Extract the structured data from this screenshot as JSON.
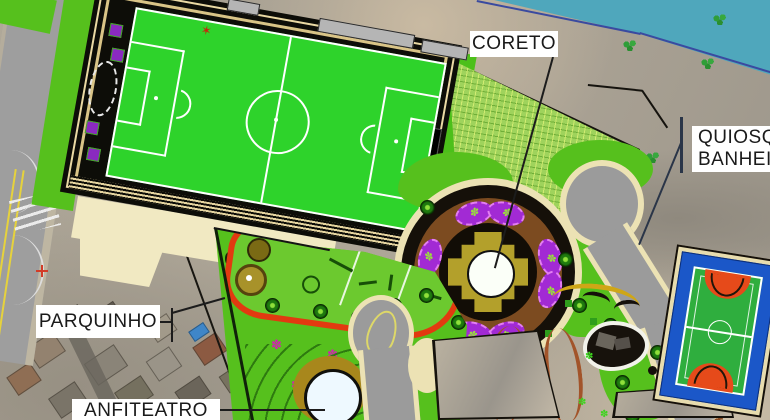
{
  "title": "Park master plan over aerial photo",
  "labels": {
    "coreto": "CORETO",
    "quiosque_line1": "QUIOSQUE",
    "quiosque_line2": "BANHEIRO",
    "parquinho": "PARQUINHO",
    "anfiteatro": "ANFITEATRO"
  },
  "glyphs": {
    "flower": "✽",
    "star": "✶"
  },
  "colors": {
    "field_green": "#2ed32b",
    "lawn_green": "#56c01d",
    "hatch_green": "#9fd35c",
    "water_teal": "#4fa7bc",
    "shoreline_blue": "#3a4aa0",
    "road_gray": "#9b9b9b",
    "sidewalk_cream": "#ece2b4",
    "plaza_brown": "#7c4b20",
    "platform_khaki": "#b3a02b",
    "flowerbed_purple": "#a22ad4",
    "court_blue": "#1b57c8",
    "court_key_orange": "#e64a1a",
    "playground_path_red": "#e23a10",
    "label_bg": "#ffffff",
    "label_text": "#1a1a1a"
  }
}
